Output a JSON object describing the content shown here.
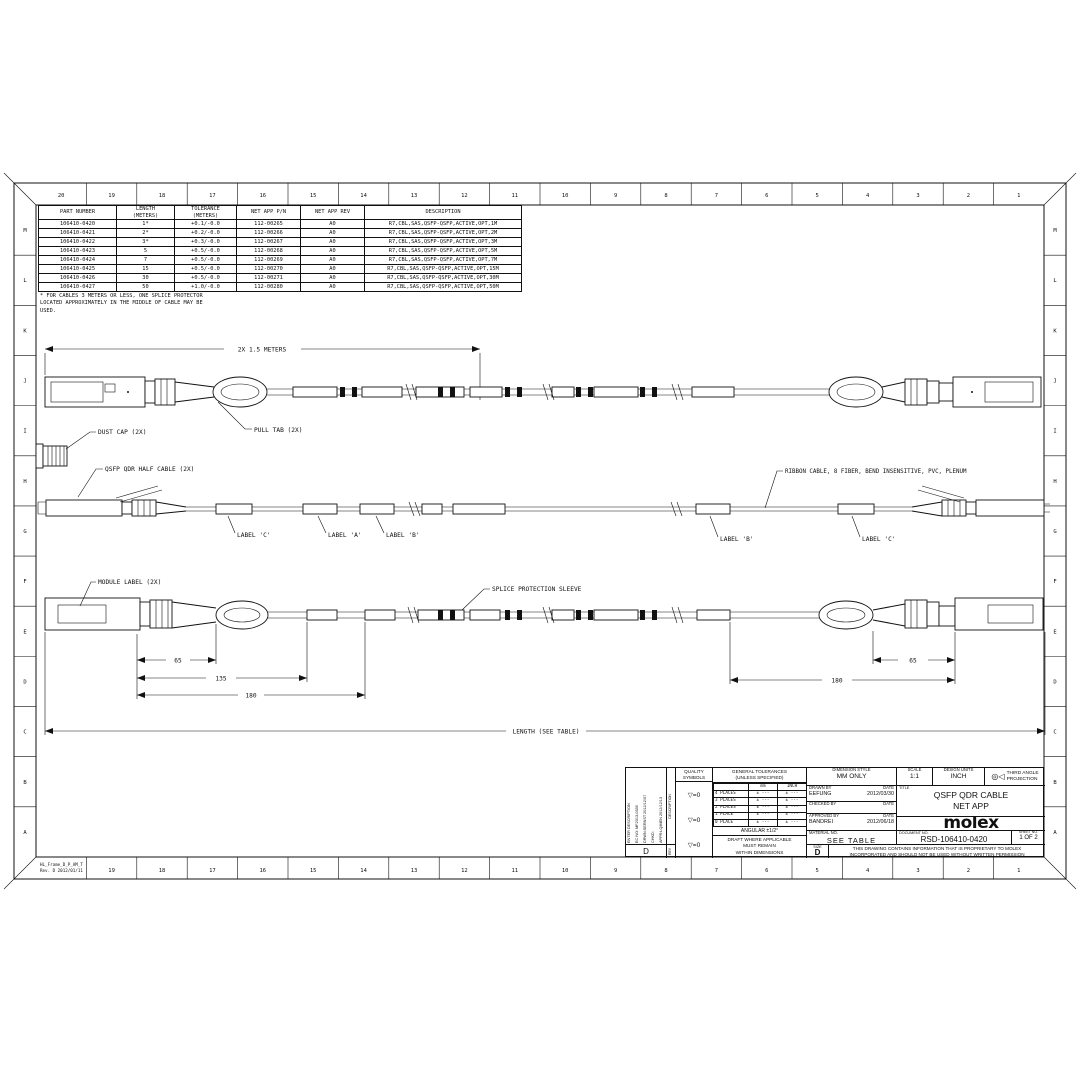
{
  "sheet": {
    "frame_ref": "HL_Frame_D_P_AM_T",
    "frame_rev": "Rev. D 2012/01/11",
    "zone_numbers": [
      "20",
      "19",
      "18",
      "17",
      "16",
      "15",
      "14",
      "13",
      "12",
      "11",
      "10",
      "9",
      "8",
      "7",
      "6",
      "5",
      "4",
      "3",
      "2",
      "1"
    ],
    "zone_letters": [
      "M",
      "L",
      "K",
      "J",
      "I",
      "H",
      "G",
      "F",
      "E",
      "D",
      "C",
      "B",
      "A"
    ]
  },
  "parts_table": {
    "headers": [
      "PART NUMBER",
      [
        "LENGTH",
        "(METERS)"
      ],
      [
        "TOLERANCE",
        "(METERS)"
      ],
      "NET APP P/N",
      "NET APP REV",
      "DESCRIPTION"
    ],
    "rows": [
      [
        "106410-0420",
        "1*",
        "+0.1/-0.0",
        "112-00265",
        "A0",
        "R7,CBL,SAS,QSFP-QSFP,ACTIVE,OPT,1M"
      ],
      [
        "106410-0421",
        "2*",
        "+0.2/-0.0",
        "112-00266",
        "A0",
        "R7,CBL,SAS,QSFP-QSFP,ACTIVE,OPT,2M"
      ],
      [
        "106410-0422",
        "3*",
        "+0.3/-0.0",
        "112-00267",
        "A0",
        "R7,CBL,SAS,QSFP-QSFP,ACTIVE,OPT,3M"
      ],
      [
        "106410-0423",
        "5",
        "+0.5/-0.0",
        "112-00268",
        "A0",
        "R7,CBL,SAS,QSFP-QSFP,ACTIVE,OPT,5M"
      ],
      [
        "106410-0424",
        "7",
        "+0.5/-0.0",
        "112-00269",
        "A0",
        "R7,CBL,SAS,QSFP-QSFP,ACTIVE,OPT,7M"
      ],
      [
        "106410-0425",
        "15",
        "+0.5/-0.0",
        "112-00270",
        "A0",
        "R7,CBL,SAS,QSFP-QSFP,ACTIVE,OPT,15M"
      ],
      [
        "106410-0426",
        "30",
        "+0.5/-0.0",
        "112-00271",
        "A0",
        "R7,CBL,SAS,QSFP-QSFP,ACTIVE,OPT,30M"
      ],
      [
        "106410-0427",
        "50",
        "+1.0/-0.0",
        "112-00280",
        "A0",
        "R7,CBL,SAS,QSFP-QSFP,ACTIVE,OPT,50M"
      ]
    ],
    "note_lines": [
      "* FOR CABLES 3 METERS OR LESS, ONE SPLICE PROTECTOR",
      "LOCATED APPROXIMATELY IN THE MIDDLE OF CABLE MAY BE",
      "USED."
    ]
  },
  "drawing": {
    "view_top": {
      "dim_label": "2X 1.5 METERS",
      "dust_cap_label": "DUST CAP (2X)",
      "pull_tab_label": "PULL TAB (2X)"
    },
    "view_mid": {
      "half_cable_label": "QSFP QDR HALF CABLE (2X)",
      "ribbon_label": "RIBBON CABLE, 8 FIBER, BEND INSENSITIVE, PVC, PLENUM",
      "label_c_left": "LABEL 'C'",
      "label_a": "LABEL 'A'",
      "label_b_left": "LABEL 'B'",
      "label_b_right": "LABEL 'B'",
      "label_c_right": "LABEL 'C'"
    },
    "view_bottom": {
      "module_label": "MODULE LABEL (2X)",
      "splice_label": "SPLICE PROTECTION SLEEVE",
      "dim_65_left": "65",
      "dim_135": "135",
      "dim_180_left": "180",
      "dim_65_right": "65",
      "dim_180_right": "180",
      "length_label": "LENGTH (SEE TABLE)"
    }
  },
  "title_block": {
    "rev_block": {
      "lines": [
        "ENTER DESCRIPTION",
        "EC NO: MF2013-0339",
        "DRWN:SERNST  2012/12/07",
        "CHKD:",
        "APPR:LQIMEN  2012/12/13"
      ],
      "rev": "D",
      "description_label": "DESCRIPTION",
      "rev_label": "REV"
    },
    "quality": {
      "label": [
        "QUALITY",
        "SYMBOLS"
      ],
      "symbols": [
        "▽=0",
        "▽=0",
        "▽=0"
      ]
    },
    "tolerances": {
      "title_lines": [
        "GENERAL TOLERANCES",
        "(UNLESS SPECIFIED)"
      ],
      "col_mm": "mm",
      "col_inch": "INCH",
      "rows": [
        [
          "4 PLACES",
          "± ---",
          "± ---"
        ],
        [
          "3 PLACES",
          "± ---",
          "± ---"
        ],
        [
          "2 PLACES",
          "± ---",
          "± ---"
        ],
        [
          "1 PLACE",
          "± ---",
          "± ---"
        ],
        [
          "0 PLACE",
          "± ---",
          "± ---"
        ]
      ],
      "angular": "ANGULAR ±1/2°",
      "draft_lines": [
        "DRAFT WHERE APPLICABLE",
        "MUST REMAIN",
        "WITHIN DIMENSIONS"
      ]
    },
    "dimension_style": {
      "label": "DIMENSION STYLE",
      "value": "MM ONLY"
    },
    "drawn": {
      "label": "DRAWN BY",
      "date_label": "DATE",
      "name": "EEFUNG",
      "date": "2012/03/30"
    },
    "checked": {
      "label": "CHECKED BY",
      "date_label": "DATE",
      "name": "",
      "date": ""
    },
    "approved": {
      "label": "APPROVED BY",
      "date_label": "DATE",
      "name": "BANDREI",
      "date": "2012/06/18"
    },
    "material": {
      "label": "MATERIAL NO.",
      "value": "SEE TABLE"
    },
    "size": {
      "label": "SIZE",
      "value": "D"
    },
    "proprietary": [
      "THIS DRAWING CONTAINS INFORMATION THAT IS PROPRIETARY TO MOLEX",
      "INCORPORATED AND SHOULD NOT BE USED WITHOUT WRITTEN PERMISSION"
    ],
    "scale": {
      "label": "SCALE",
      "value": "1:1"
    },
    "design_units": {
      "label": "DESIGN UNITS",
      "value": "INCH"
    },
    "projection": {
      "symbol": "◎◁",
      "label_lines": [
        "THIRD ANGLE",
        "PROJECTION"
      ]
    },
    "title": {
      "label": "TITLE",
      "lines": [
        "QSFP QDR CABLE",
        "NET APP"
      ]
    },
    "logo": "molex",
    "document": {
      "label": "DOCUMENT NO.",
      "value": "RSD-106410-0420"
    },
    "sheet_no": {
      "label": "SHEET NO.",
      "value": "1 OF 2"
    }
  }
}
